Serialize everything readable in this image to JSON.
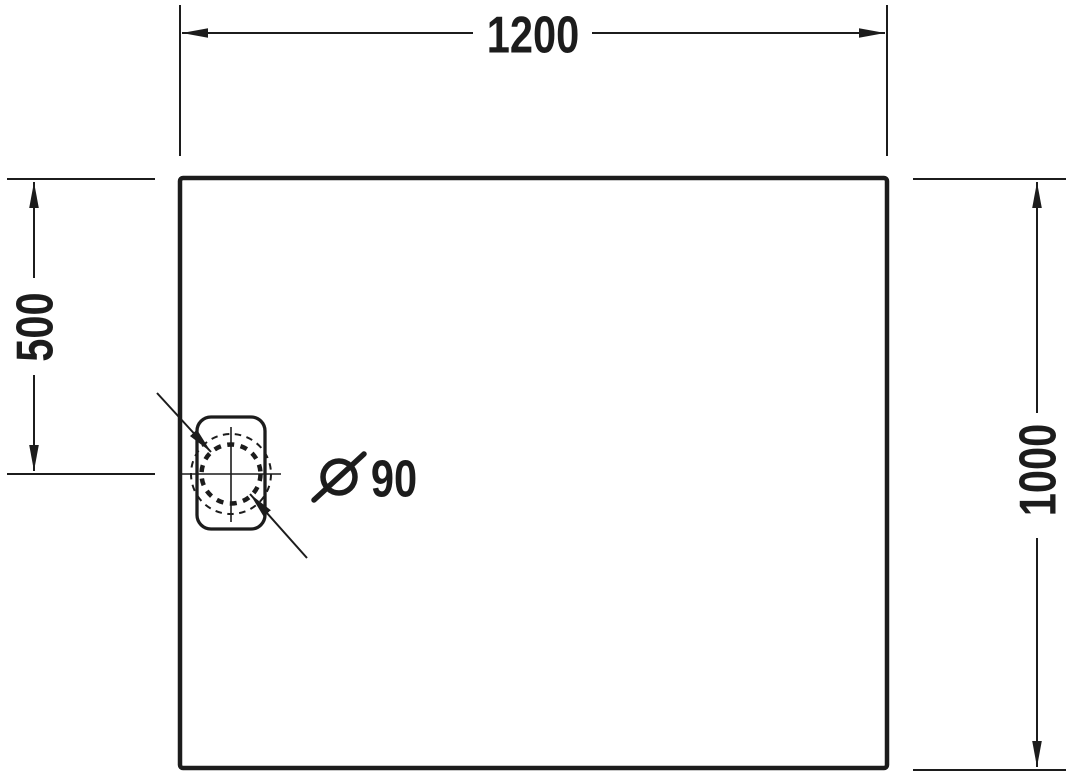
{
  "colors": {
    "ink": "#1c1c1c",
    "background": "#ffffff"
  },
  "dimensions": {
    "width_label": "1200",
    "height_label": "1000",
    "drain_offset_label": "500",
    "drain_diameter_symbol": "Ø",
    "drain_diameter_value": "90"
  }
}
